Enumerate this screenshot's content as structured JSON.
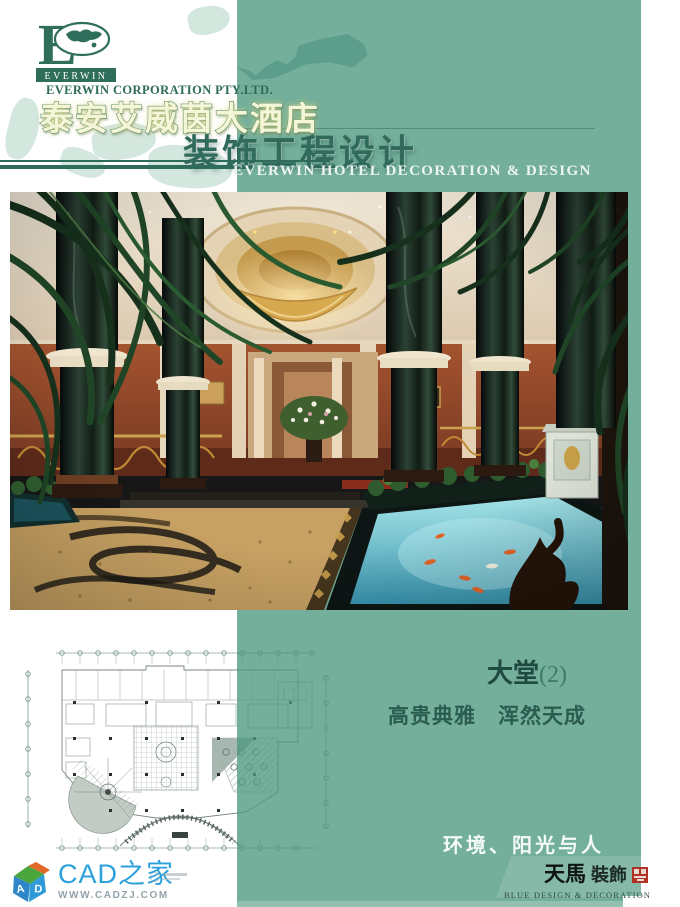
{
  "header": {
    "logo_monogram": "E",
    "logo_banner": "EVERWIN",
    "company": "EVERWIN CORPORATION PTY.LTD.",
    "hotel_name": "泰安艾威茵大酒店",
    "main_title": "装饰工程设计",
    "subtitle": "EVERWIN HOTEL DECORATION & DESIGN"
  },
  "content": {
    "room_title": "大堂",
    "room_index": "(2)",
    "tagline": "高贵典雅　浑然天成",
    "slogan": "环境、阳光与人"
  },
  "designer": {
    "name_cn": "天馬",
    "name_cn_suffix": "裝飾",
    "name_en": "BLUE DESIGN & DECORATION"
  },
  "site": {
    "name": "CAD之家",
    "url": "WWW.CADZJ.COM",
    "cube_letter_a": "A",
    "cube_letter_d": "D"
  },
  "colors": {
    "teal": "#7fb5a3",
    "teal_dark": "#5c9d8b",
    "green_dark": "#2e6b5b",
    "title_fill": "#f5f6d8",
    "seal_red": "#b23126",
    "site_blue": "#2da0dc"
  }
}
